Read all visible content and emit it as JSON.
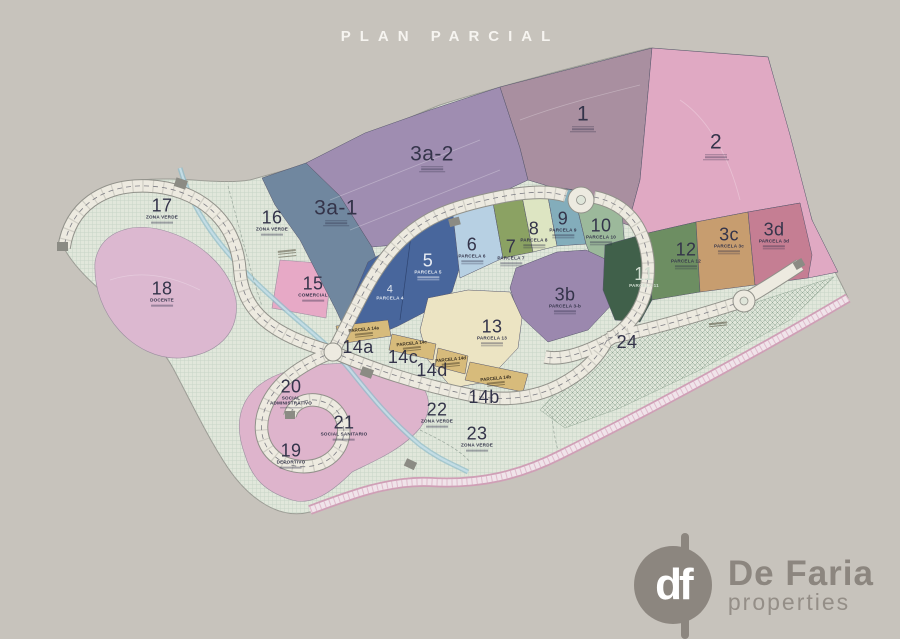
{
  "title": "PLAN PARCIAL",
  "logo": {
    "monogram": "df",
    "name": "De Faria",
    "tagline": "properties"
  },
  "parcels": [
    {
      "number": "1",
      "sub": "PARCELA 1",
      "color": "#a98fa0"
    },
    {
      "number": "2",
      "sub": "PARCELA 2",
      "color": "#e0a9c3"
    },
    {
      "number": "3a-1",
      "sub": "PARCELA 3a-1",
      "color": "#70879f"
    },
    {
      "number": "3a-2",
      "sub": "PARCELA 3a-2",
      "color": "#9f8db1"
    },
    {
      "number": "3b",
      "sub": "PARCELA 3-b",
      "color": "#9b88ae"
    },
    {
      "number": "3c",
      "sub": "PARCELA 3c",
      "color": "#c79d6f"
    },
    {
      "number": "3d",
      "sub": "PARCELA 3d",
      "color": "#c57e93"
    },
    {
      "number": "4",
      "sub": "PARCELA 4",
      "color": "#3e5b8e"
    },
    {
      "number": "5",
      "sub": "PARCELA 5",
      "color": "#48669c"
    },
    {
      "number": "6",
      "sub": "PARCELA 6",
      "color": "#b7d0e3"
    },
    {
      "number": "7",
      "sub": "PARCELA 7",
      "color": "#8ba263"
    },
    {
      "number": "8",
      "sub": "PARCELA 8",
      "color": "#dde5c2"
    },
    {
      "number": "9",
      "sub": "PARCELA 9",
      "color": "#83adbb"
    },
    {
      "number": "10",
      "sub": "PARCELA 10",
      "color": "#9cb99b"
    },
    {
      "number": "11",
      "sub": "PARCELA 11",
      "color": "#40604a"
    },
    {
      "number": "12",
      "sub": "PARCELA 12",
      "color": "#6d8e62"
    },
    {
      "number": "13",
      "sub": "PARCELA 13",
      "color": "#ece4c3"
    },
    {
      "number": "14a",
      "sub": "PARCELA 14a",
      "color": "#d7bb7b"
    },
    {
      "number": "14b",
      "sub": "PARCELA 14b",
      "color": "#d7bb7b"
    },
    {
      "number": "14c",
      "sub": "PARCELA 14c",
      "color": "#d7bb7b"
    },
    {
      "number": "14d",
      "sub": "PARCELA 14d",
      "color": "#d7bb7b"
    },
    {
      "number": "15",
      "sub": "COMERCIAL",
      "color": "#e7a9c6"
    },
    {
      "number": "16",
      "sub": "ZONA VERDE",
      "color": "#e1e7db"
    },
    {
      "number": "17",
      "sub": "ZONA VERDE",
      "color": "#e1e7db"
    },
    {
      "number": "18",
      "sub": "DOCENTE",
      "color": "#dcb8d0"
    },
    {
      "number": "19",
      "sub": "DEPORTIVO",
      "color": "#deb4cc"
    },
    {
      "number": "20",
      "sub": "SOCIAL ADMINISTRATIVO",
      "color": "#deb4cc"
    },
    {
      "number": "21",
      "sub": "SOCIAL SANITARIO",
      "color": "#deb4cc"
    },
    {
      "number": "22",
      "sub": "ZONA VERDE",
      "color": "#e1e7db"
    },
    {
      "number": "23",
      "sub": "ZONA VERDE",
      "color": "#e1e7db"
    },
    {
      "number": "24",
      "sub": "",
      "color": "#e1e7db"
    }
  ]
}
